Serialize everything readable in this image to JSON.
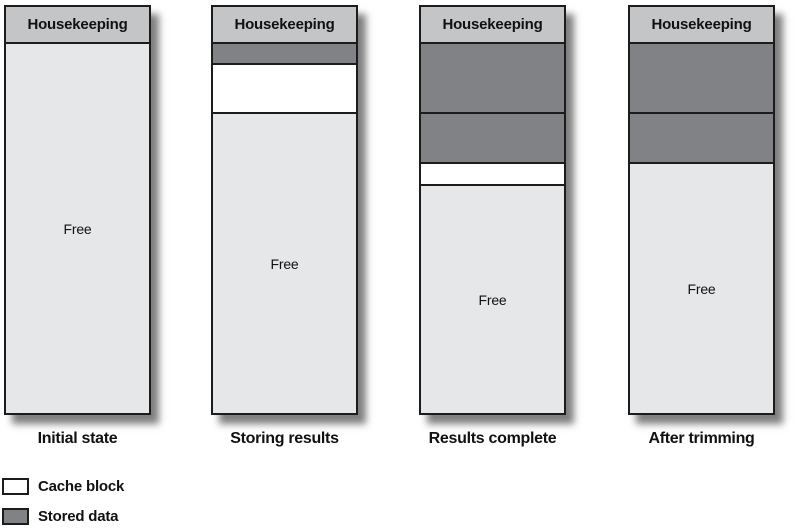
{
  "figure": {
    "colors": {
      "header": "#c4c5c7",
      "stored": "#808285",
      "free": "#e6e7e8",
      "cache": "#ffffff",
      "border": "#1c1c1c"
    },
    "columns": [
      {
        "header": "Housekeeping",
        "caption": "Initial state",
        "left": 4,
        "segments": [
          {
            "type": "free",
            "label": "Free"
          }
        ]
      },
      {
        "header": "Housekeeping",
        "caption": "Storing results",
        "left": 211,
        "segments": [
          {
            "type": "stored",
            "h": 19
          },
          {
            "type": "cache",
            "h": 47
          },
          {
            "type": "free",
            "label": "Free"
          }
        ]
      },
      {
        "header": "Housekeeping",
        "caption": "Results complete",
        "left": 419,
        "segments": [
          {
            "type": "stored",
            "h": 68
          },
          {
            "type": "stored",
            "h": 48
          },
          {
            "type": "cache",
            "h": 20
          },
          {
            "type": "free",
            "label": "Free"
          }
        ]
      },
      {
        "header": "Housekeeping",
        "caption": "After trimming",
        "left": 628,
        "segments": [
          {
            "type": "stored",
            "h": 68
          },
          {
            "type": "stored",
            "h": 48
          },
          {
            "type": "free",
            "label": "Free"
          }
        ]
      }
    ],
    "legend": [
      {
        "type": "cache",
        "label": "Cache block",
        "top": 478
      },
      {
        "type": "stored",
        "label": "Stored data",
        "top": 508
      }
    ]
  }
}
